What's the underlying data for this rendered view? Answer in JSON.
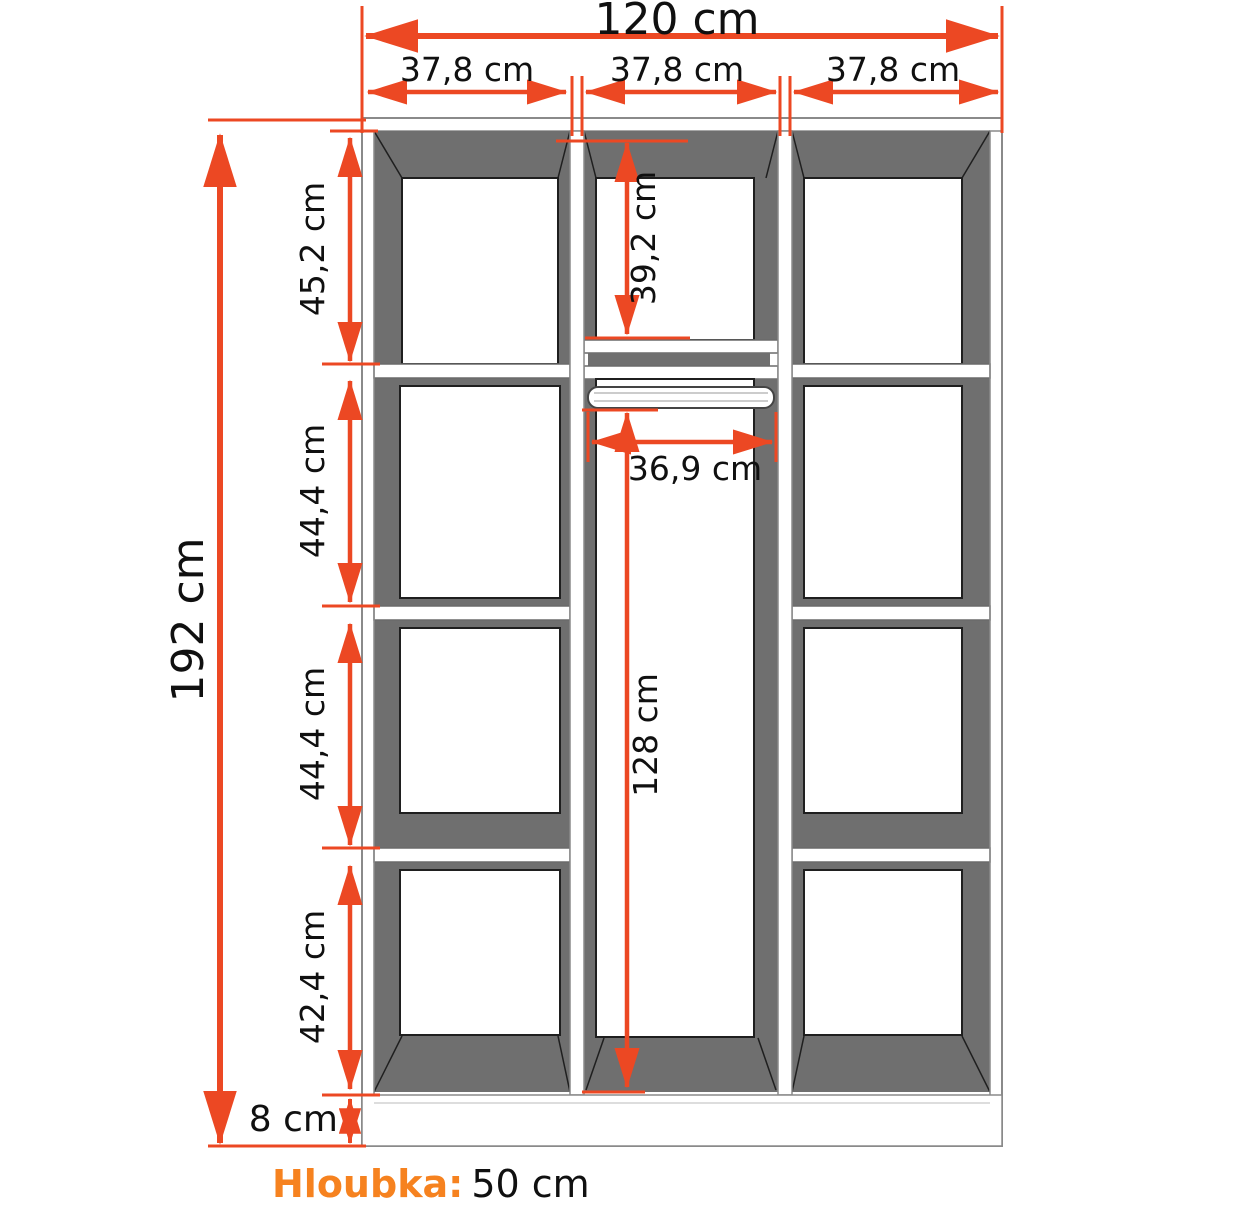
{
  "labels": {
    "total_width": "120 cm",
    "section_widths": [
      "37,8 cm",
      "37,8 cm",
      "37,8 cm"
    ],
    "total_height": "192 cm",
    "compartment_heights": [
      "45,2 cm",
      "44,4 cm",
      "44,4 cm",
      "42,4 cm"
    ],
    "plinth_height": "8 cm",
    "middle_shelf_height": "39,2 cm",
    "rail_width": "36,9 cm",
    "hanging_space_height": "128 cm",
    "depth_label": "Hloubka:",
    "depth_value": "50 cm"
  },
  "colors": {
    "dimension_arrow": "#EC4823",
    "depth_accent": "#F6821F",
    "interior_shade": "#6F6F6F"
  }
}
